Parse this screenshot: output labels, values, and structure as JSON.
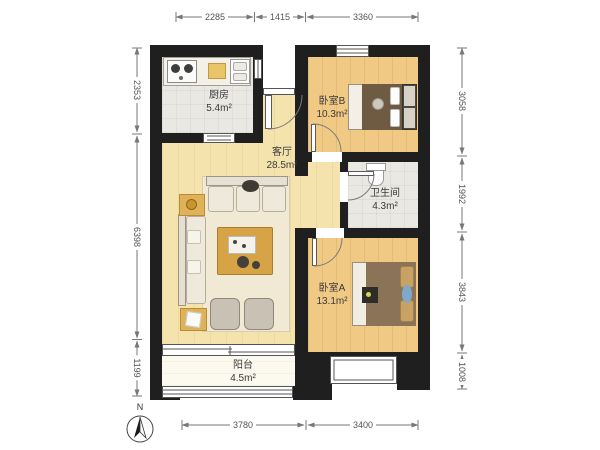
{
  "title": "apartment-floorplan",
  "rooms": [
    {
      "id": "kitchen",
      "name": "厨房",
      "area": "5.4m²"
    },
    {
      "id": "bedroomB",
      "name": "卧室B",
      "area": "10.3m²"
    },
    {
      "id": "living",
      "name": "客厅",
      "area": "28.5m²"
    },
    {
      "id": "bathroom",
      "name": "卫生间",
      "area": "4.3m²"
    },
    {
      "id": "bedroomA",
      "name": "卧室A",
      "area": "13.1m²"
    },
    {
      "id": "balcony",
      "name": "阳台",
      "area": "4.5m²"
    }
  ],
  "dimensions": {
    "top": [
      "2285",
      "1415",
      "3360"
    ],
    "left": [
      "2353",
      "6398",
      "1199"
    ],
    "right": [
      "3058",
      "1992",
      "3843",
      "1008"
    ],
    "bottom": [
      "3780",
      "3400"
    ]
  },
  "compass": {
    "label": "N"
  },
  "colors": {
    "wall": "#1f1f1f",
    "wood_living": "#f5e3ae",
    "wood_bedroom": "#f0c985",
    "tile": "#eae8e2",
    "balcony_floor": "#fcf9ee",
    "table_accent": "#dfb259",
    "coffee_table": "#d6a346",
    "duvet_bedroom_a": "#8b7357",
    "duvet_bedroom_b": "#6e5b41",
    "pillow_tan": "#c8a265",
    "pillow_blue": "#7fa8c9",
    "dimension_text": "#555555",
    "label_text": "#3a3a3a"
  }
}
